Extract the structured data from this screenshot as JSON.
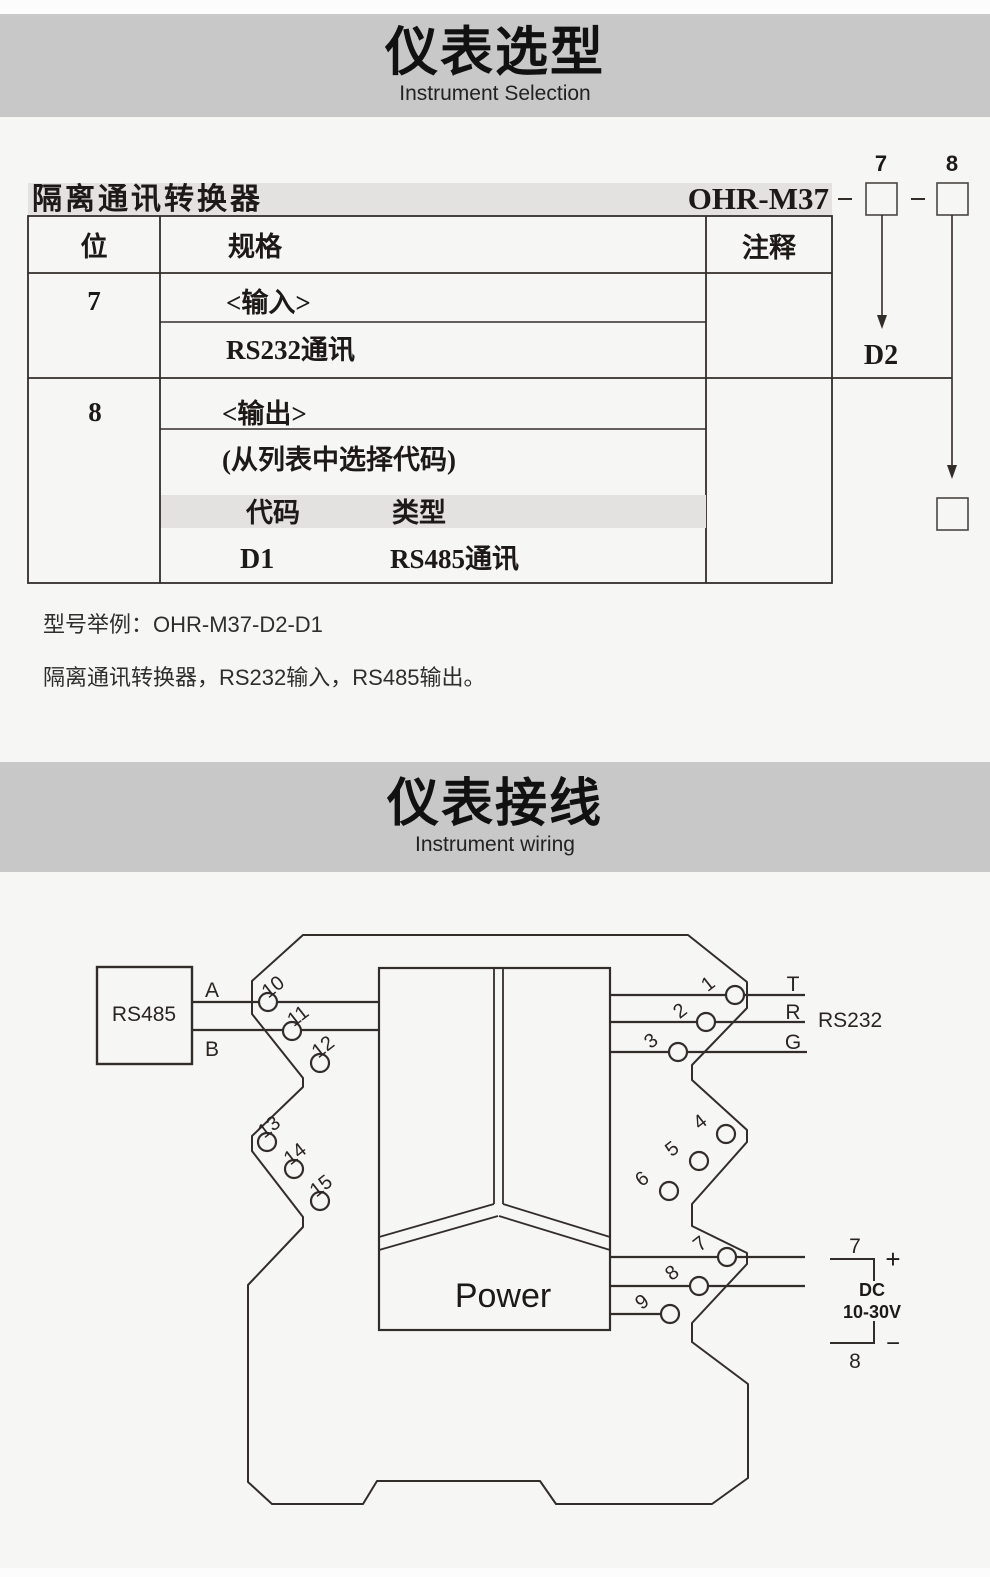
{
  "colors": {
    "page_bg": "#f6f6f4",
    "band_gray": "#c9c8c8",
    "light_gray_band": "#e3e2e1",
    "line_ink": "#332d2a",
    "text_ink": "#1d1916"
  },
  "header_selection": {
    "title": "仪表选型",
    "subtitle": "Instrument Selection"
  },
  "header_wiring": {
    "title": "仪表接线",
    "subtitle": "Instrument wiring"
  },
  "selection": {
    "product_name": "隔离通讯转换器",
    "model": "OHR-M37",
    "digit7": "7",
    "digit8": "8",
    "code_under_digit7": "D2",
    "col_position": "位",
    "col_spec": "规格",
    "col_note": "注释",
    "row7": {
      "position": "7",
      "group": "<输入>",
      "value": "RS232通讯"
    },
    "row8": {
      "position": "8",
      "group": "<输出>",
      "hint": "(从列表中选择代码)",
      "code_col": "代码",
      "type_col": "类型",
      "code": "D1",
      "type": "RS485通讯"
    },
    "example_title": "型号举例：OHR-M37-D2-D1",
    "example_desc": "隔离通讯转换器，RS232输入，RS485输出。"
  },
  "wiring": {
    "device_left": "RS485",
    "label_a": "A",
    "label_b": "B",
    "label_t": "T",
    "label_r": "R",
    "label_g": "G",
    "device_right": "RS232",
    "power": "Power",
    "dc_top": "7",
    "dc_plus": "+",
    "dc_name": "DC",
    "dc_range": "10-30V",
    "dc_minus": "−",
    "dc_bottom": "8",
    "terminals_left": [
      "10",
      "11",
      "12",
      "13",
      "14",
      "15"
    ],
    "terminals_right": [
      "1",
      "2",
      "3",
      "4",
      "5",
      "6",
      "7",
      "8",
      "9"
    ]
  }
}
